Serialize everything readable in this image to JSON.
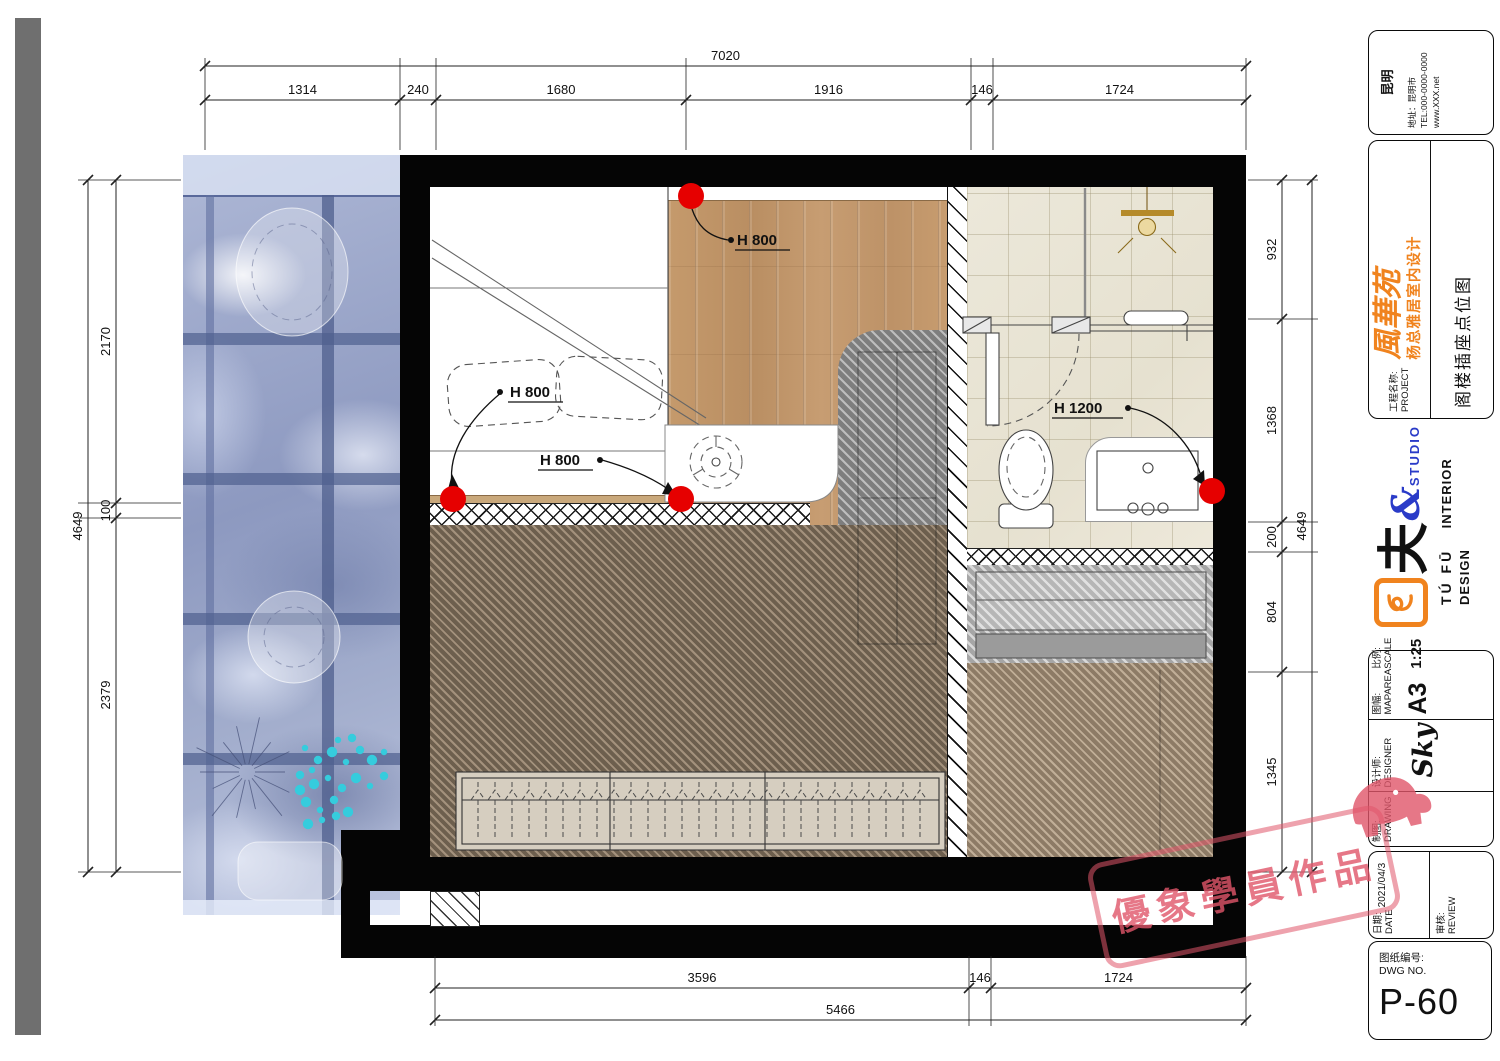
{
  "dims": {
    "top_overall": "7020",
    "top": [
      "1314",
      "240",
      "1680",
      "1916",
      "146",
      "1724"
    ],
    "left_overall": "4649",
    "left": [
      "2170",
      "100",
      "2379"
    ],
    "right": [
      "932",
      "1368",
      "200",
      "804",
      "1345"
    ],
    "right_overall": "4649",
    "bottom": [
      "3596",
      "146",
      "1724"
    ],
    "bottom_overall": "5466"
  },
  "plan": {
    "socket_labels": [
      "H  800",
      "H  800",
      "H  800",
      "H  1200"
    ],
    "socket_color": "#e60000"
  },
  "titleblock": {
    "city": "昆明",
    "address": "地址：昆明市",
    "tel": "TEL:000-0000-0000",
    "web": "www.XXX.net",
    "project_label": "工程名称:",
    "project_label_en": "PROJECT",
    "brand_script": "風華苑",
    "project_name": "杨总雅居室内设计",
    "drawing_title": "阁楼插座点位图",
    "logo_glyph": "夫",
    "logo_amp": "&",
    "logo_studio": "STUDIO",
    "logo_pinyin": "TÚ FŪ",
    "logo_en": "INTERIOR DESIGN",
    "drawing_label": "制图:",
    "drawing_label_en": "DRAWING",
    "designer_label": "设计师:",
    "designer_label_en": "DESIGNER",
    "designer": "Sky",
    "maparea_label": "图幅:",
    "maparea_label_en": "MAPAREA",
    "maparea": "A3",
    "scale_label": "比例:",
    "scale_label_en": "SCALE",
    "scale": "1:25",
    "date_label": "日期:",
    "date_label_en": "DATE",
    "date": "2021/04/3",
    "review_label": "审核:",
    "review_label_en": "REVIEW",
    "dwg_label": "图纸编号:",
    "dwg_label_en": "DWG NO.",
    "dwg_no": "P-60"
  },
  "watermark": {
    "text": "優象學員作品"
  },
  "colors": {
    "accent_orange": "#f0831e",
    "logo_blue": "#2a3bc8",
    "socket_red": "#e60000",
    "stamp_pink": "#e0556a"
  }
}
